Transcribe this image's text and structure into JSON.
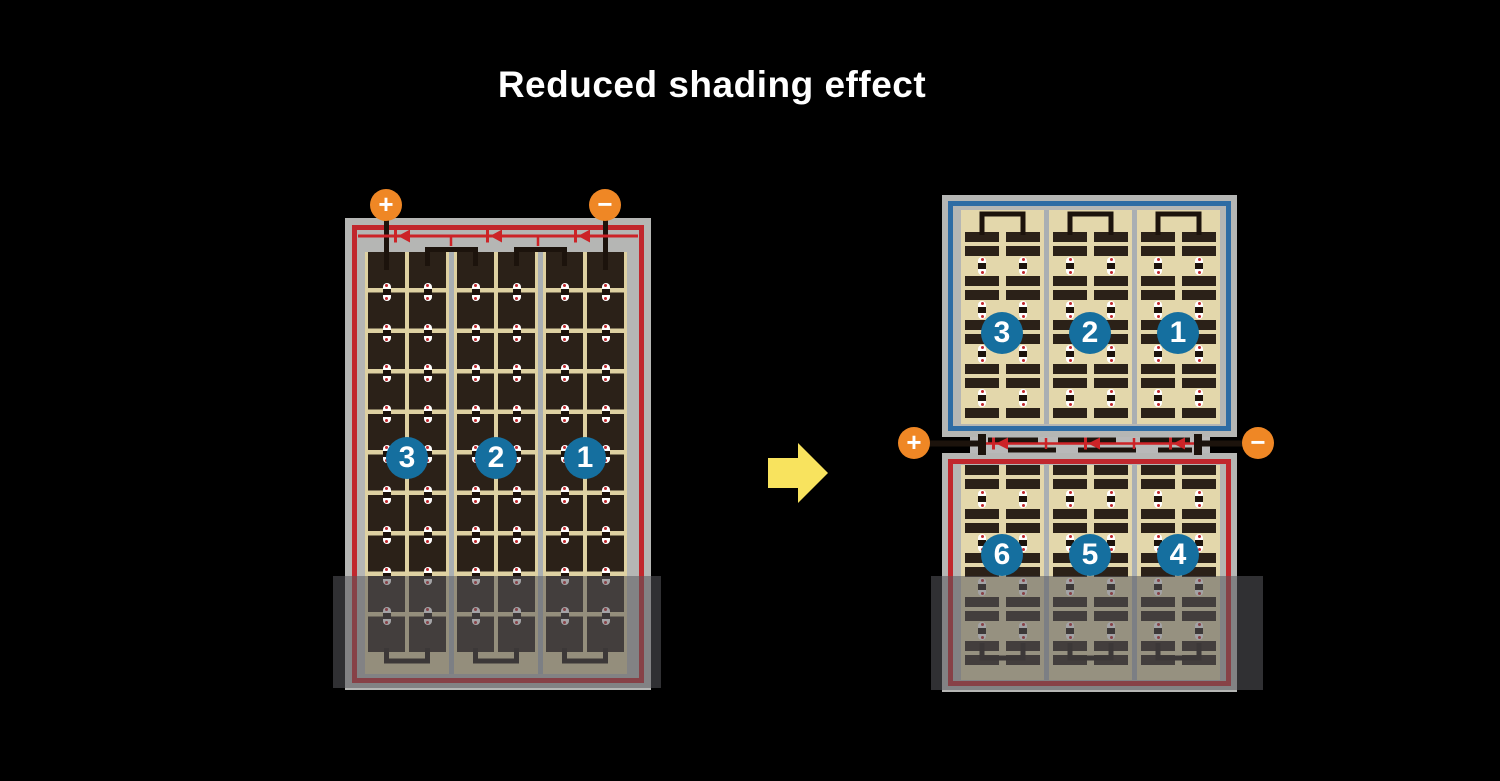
{
  "title": "Reduced shading effect",
  "left_panel": {
    "terminal_positive": "+",
    "terminal_negative": "−",
    "string_numbers": [
      "3",
      "2",
      "1"
    ]
  },
  "right_panel": {
    "terminal_positive": "+",
    "terminal_negative": "−",
    "top_string_numbers": [
      "3",
      "2",
      "1"
    ],
    "bottom_string_numbers": [
      "6",
      "5",
      "4"
    ]
  },
  "arrow": {
    "direction": "right"
  },
  "colors": {
    "background": "#000000",
    "title_text": "#ffffff",
    "frame_gray": "#b5b6b4",
    "panel_outline_red": "#c1272d",
    "panel_outline_blue": "#2e6ca4",
    "badge_blue": "#156f9f",
    "cell_tan": "#ded1a2",
    "cell_dark": "#2b2118",
    "terminal_orange": "#ef8725",
    "arrow_yellow": "#f8e35e",
    "diode_red": "#cc2327",
    "wire_black": "#1c130c"
  }
}
